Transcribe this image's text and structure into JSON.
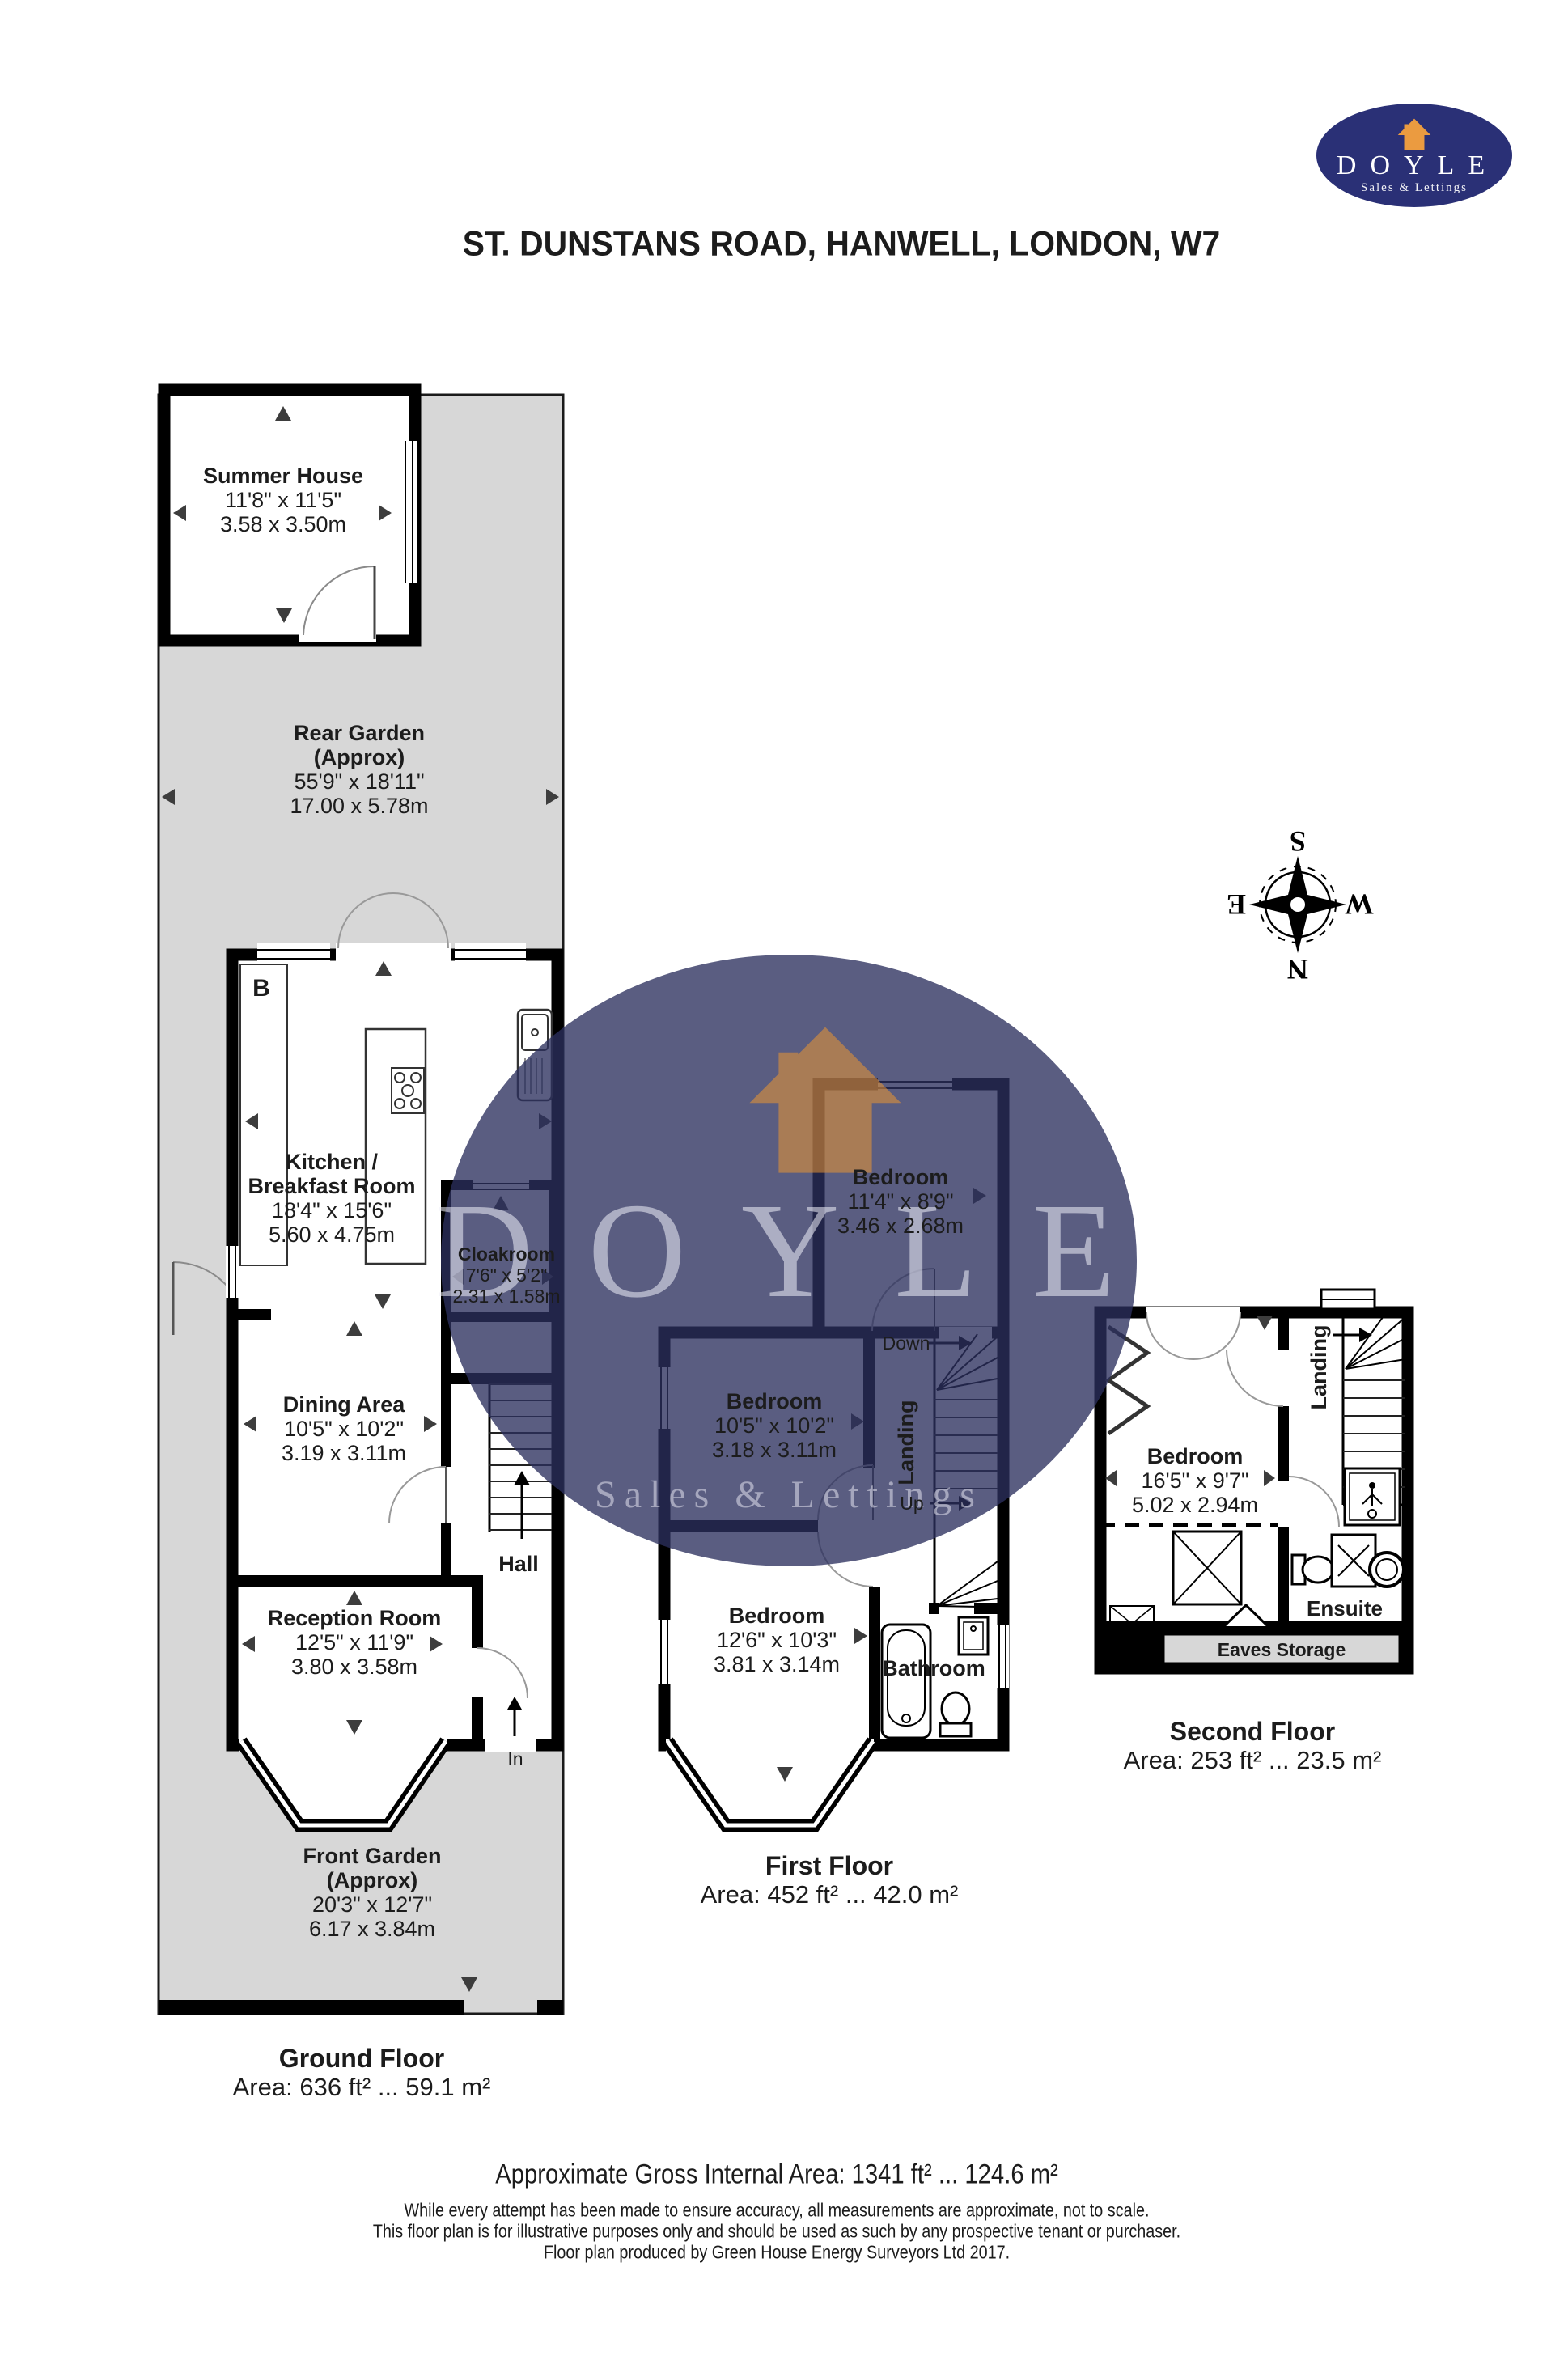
{
  "title": "ST. DUNSTANS ROAD, HANWELL, LONDON, W7",
  "logo": {
    "name": "DOYLE",
    "tagline": "Sales & Lettings"
  },
  "watermark": {
    "name": "DOYLE",
    "tagline": "Sales & Lettings"
  },
  "compass": {
    "n": "N",
    "s": "S",
    "e": "E",
    "w": "W"
  },
  "ground_floor": {
    "label": "Ground Floor",
    "area": "Area: 636 ft² ... 59.1 m²",
    "boiler_label": "B",
    "entrance_label": "In",
    "summer_house": {
      "name": "Summer House",
      "dims_ft": "11'8\" x 11'5\"",
      "dims_m": "3.58 x 3.50m"
    },
    "rear_garden": {
      "name": "Rear Garden",
      "approx": "(Approx)",
      "dims_ft": "55'9\" x 18'11\"",
      "dims_m": "17.00 x 5.78m"
    },
    "kitchen": {
      "name_line1": "Kitchen /",
      "name_line2": "Breakfast Room",
      "dims_ft": "18'4\" x 15'6\"",
      "dims_m": "5.60 x 4.75m"
    },
    "cloakroom": {
      "name": "Cloakroom",
      "dims_ft": "7'6\" x 5'2\"",
      "dims_m": "2.31 x 1.58m"
    },
    "dining": {
      "name": "Dining Area",
      "dims_ft": "10'5\" x 10'2\"",
      "dims_m": "3.19 x 3.11m"
    },
    "hall": {
      "name": "Hall"
    },
    "reception": {
      "name": "Reception Room",
      "dims_ft": "12'5\" x 11'9\"",
      "dims_m": "3.80 x 3.58m"
    },
    "front_garden": {
      "name": "Front Garden",
      "approx": "(Approx)",
      "dims_ft": "20'3\" x 12'7\"",
      "dims_m": "6.17 x 3.84m"
    }
  },
  "first_floor": {
    "label": "First Floor",
    "area": "Area: 452 ft² ... 42.0 m²",
    "bedroom_rear": {
      "name": "Bedroom",
      "dims_ft": "11'4\" x 8'9\"",
      "dims_m": "3.46 x 2.68m"
    },
    "bedroom_middle": {
      "name": "Bedroom",
      "dims_ft": "10'5\" x 10'2\"",
      "dims_m": "3.18 x 3.11m"
    },
    "bedroom_front": {
      "name": "Bedroom",
      "dims_ft": "12'6\" x 10'3\"",
      "dims_m": "3.81 x 3.14m"
    },
    "landing": {
      "name": "Landing"
    },
    "bathroom": {
      "name": "Bathroom"
    },
    "stairs": {
      "down": "Down",
      "up": "Up"
    }
  },
  "second_floor": {
    "label": "Second Floor",
    "area": "Area: 253 ft² ... 23.5 m²",
    "bedroom": {
      "name": "Bedroom",
      "dims_ft": "16'5\" x 9'7\"",
      "dims_m": "5.02 x 2.94m"
    },
    "landing": {
      "name": "Landing"
    },
    "ensuite": {
      "name": "Ensuite"
    },
    "eaves": {
      "name": "Eaves Storage"
    }
  },
  "footer": {
    "gross_area": "Approximate Gross Internal Area: 1341 ft² ... 124.6 m²",
    "disclaimer1": "While every attempt has been made to ensure accuracy, all measurements are approximate, not to scale.",
    "disclaimer2": "This floor plan is for illustrative purposes only and should be used as such by any prospective tenant or purchaser.",
    "disclaimer3": "Floor plan produced by Green House Energy Surveyors Ltd 2017."
  },
  "colors": {
    "garden": "#d7d7d7",
    "wall": "#000000",
    "brand_navy": "#2a3076",
    "brand_orange": "#eb9b40",
    "arrow": "#3d3d3d"
  }
}
